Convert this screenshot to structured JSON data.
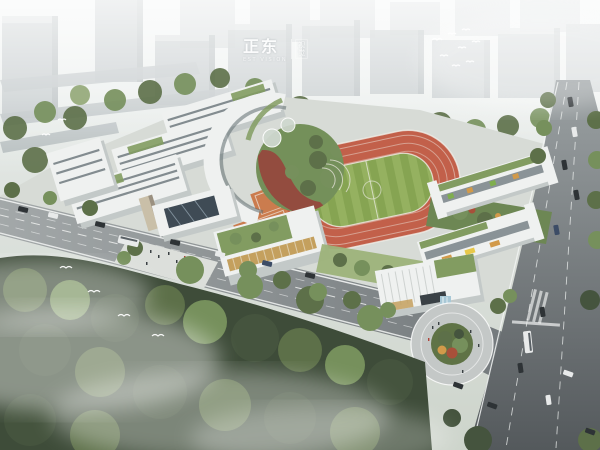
{
  "watermark": {
    "main": "正东",
    "sub": "EST VISION",
    "side_top": "视",
    "side_bottom": "觉"
  },
  "colors": {
    "haze": "#eef1f0",
    "city_face": "#a9b1b4",
    "city_top": "#c6cccd",
    "city_side": "#939da0",
    "tree_dark": "#45543e",
    "tree_mid": "#5d7049",
    "tree_light": "#76905c",
    "tree_pale": "#93a877",
    "forest_base": "#3e4c39",
    "ground": "#d7dbd6",
    "plaza": "#dcdfdb",
    "road_light": "#a0a5a6",
    "asphalt_dark": "#555a5d",
    "lane_white": "#f2f4f3",
    "building_white": "#eff1f0",
    "building_shadow": "#c3c9c8",
    "window_band": "#5f6b70",
    "glass_dark": "#3f4b55",
    "roof_green": "#829c61",
    "roof_green_light": "#9db37a",
    "track_orange": "#c2604a",
    "field_green": "#95b160",
    "field_stripe": "#86a452",
    "court_orange": "#cb7c4e",
    "red_path": "#95493e",
    "accent_red": "#a8503a",
    "accent_orange": "#d29a4a",
    "louver_tan": "#c4a05e",
    "water_blue": "#a8c8d6",
    "plaza_ring": "#c4c8c7",
    "island_green": "#5f7346"
  }
}
